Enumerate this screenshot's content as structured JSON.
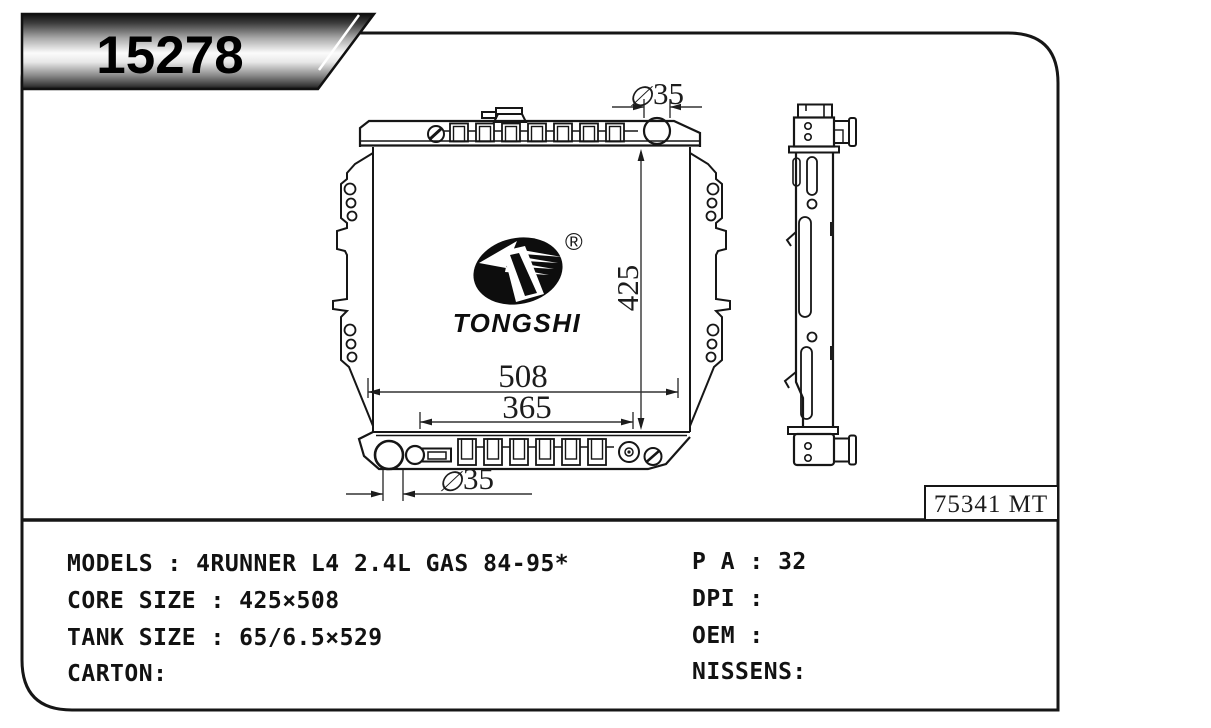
{
  "part_number": "15278",
  "logo": {
    "brand": "TONGSHI",
    "registered_mark": "®"
  },
  "ref_code": "75341 MT",
  "dimensions": {
    "top_neck_symbol": "∅",
    "top_neck_value": "35",
    "core_height": "425",
    "overall_width": "508",
    "inner_width": "365",
    "bottom_outlet_symbol": "∅",
    "bottom_outlet_value": "35"
  },
  "specs": {
    "left": [
      "MODELS : 4RUNNER L4 2.4L GAS 84-95*",
      "CORE SIZE : 425×508",
      "TANK SIZE : 65/6.5×529",
      "CARTON:"
    ],
    "right": [
      "P A : 32",
      "DPI :",
      "OEM :",
      "NISSENS:"
    ]
  },
  "colors": {
    "line": "#161616",
    "background": "#ffffff"
  }
}
